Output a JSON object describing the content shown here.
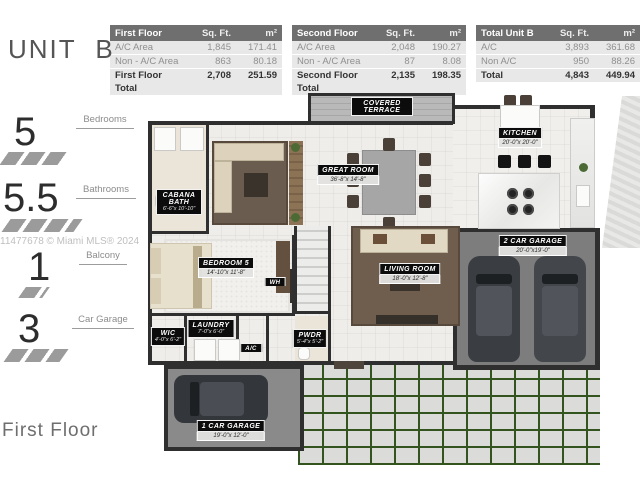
{
  "unit_title": "UNIT B",
  "floor_label": "First Floor",
  "watermark": "11477678 © Miami MLS® 2024",
  "colors": {
    "wall": "#2f2f2f",
    "label_bg": "#0c0c0c",
    "table_header_bg": "#6f6f6f",
    "driveway_grout_green": "#33531f"
  },
  "stats": [
    {
      "value": "5",
      "label": "Bedrooms"
    },
    {
      "value": "5.5",
      "label": "Bathrooms"
    },
    {
      "value": "1",
      "label": "Balcony"
    },
    {
      "value": "3",
      "label": "Car Garage"
    }
  ],
  "tables": [
    {
      "title": "First Floor",
      "col_sqft": "Sq. Ft.",
      "col_m2": "m²",
      "rows": [
        [
          "A/C Area",
          "1,845",
          "171.41"
        ],
        [
          "Non - A/C Area",
          "863",
          "80.18"
        ],
        [
          "First Floor Total",
          "2,708",
          "251.59"
        ]
      ]
    },
    {
      "title": "Second Floor",
      "col_sqft": "Sq. Ft.",
      "col_m2": "m²",
      "rows": [
        [
          "A/C Area",
          "2,048",
          "190.27"
        ],
        [
          "Non - A/C Area",
          "87",
          "8.08"
        ],
        [
          "Second Floor Total",
          "2,135",
          "198.35"
        ]
      ]
    },
    {
      "title": "Total Unit B",
      "col_sqft": "Sq. Ft.",
      "col_m2": "m²",
      "rows": [
        [
          "A/C",
          "3,893",
          "361.68"
        ],
        [
          "Non A/C",
          "950",
          "88.26"
        ],
        [
          "Total",
          "4,843",
          "449.94"
        ]
      ]
    }
  ],
  "rooms": [
    {
      "name": "COVERED TERRACE",
      "dims": ""
    },
    {
      "name": "KITCHEN",
      "dims": "20'-0\"x 20'-0\""
    },
    {
      "name": "GREAT ROOM",
      "dims": "36'-8\"x 14'-8\""
    },
    {
      "name": "CABANA BATH",
      "dims": "6'-6\"x 10'-10\""
    },
    {
      "name": "BEDROOM 5",
      "dims": "14'-10\"x 11'-8\""
    },
    {
      "name": "LIVING ROOM",
      "dims": "18'-0\"x 12'-8\""
    },
    {
      "name": "2 CAR GARAGE",
      "dims": "20'-0\"x19'-0\""
    },
    {
      "name": "WH",
      "dims": ""
    },
    {
      "name": "WIC",
      "dims": "4'-0\"x 6'-2\""
    },
    {
      "name": "LAUNDRY",
      "dims": "7'-0\"x 6'-0\""
    },
    {
      "name": "A/C",
      "dims": ""
    },
    {
      "name": "PWDR",
      "dims": "5'-4\"x 5'-2\""
    },
    {
      "name": "1 CAR GARAGE",
      "dims": "19'-0\"x 12'-0\""
    }
  ]
}
